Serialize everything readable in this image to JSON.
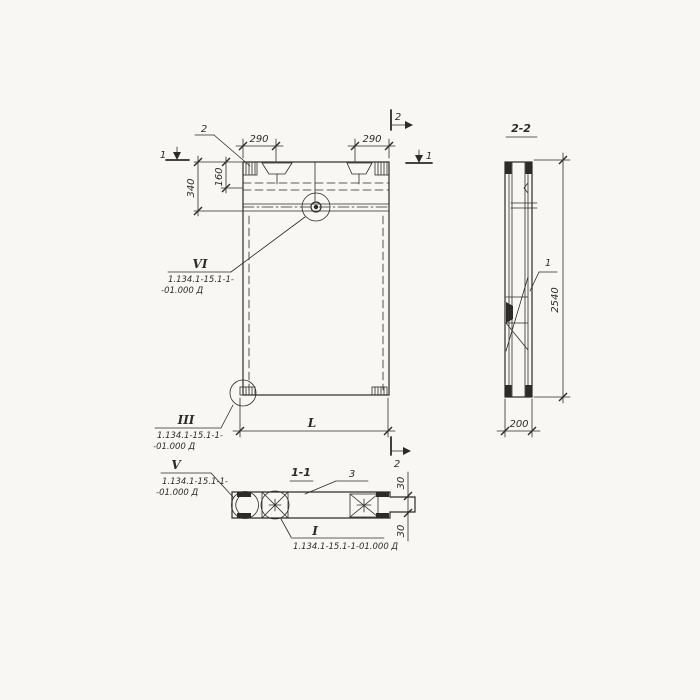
{
  "colors": {
    "ink": "#2e2b27",
    "paper": "#f8f7f4"
  },
  "front": {
    "marks": {
      "cut1_left": "1",
      "cut1_right": "1",
      "cut2_top": "2",
      "cut2_bottom": "2"
    },
    "dims": {
      "recess_left": "290",
      "recess_right": "290",
      "band_height": "340",
      "recess_depth": "160",
      "length": "L"
    },
    "item2_label": "2",
    "detail_vi": {
      "num": "VI",
      "ref1": "1.134.1-15.1-1-",
      "ref2": "-01.000 Д"
    },
    "detail_iii": {
      "num": "III",
      "ref1": "1.134.1-15.1-1-",
      "ref2": "-01.000 Д"
    }
  },
  "section11": {
    "title": "1-1",
    "item3_label": "3",
    "dims": {
      "rebate_top": "30",
      "rebate_bottom": "30"
    },
    "detail_v": {
      "num": "V",
      "ref1": "1.134.1-15.1-1-",
      "ref2": "-01.000 Д"
    },
    "detail_i": {
      "num": "I",
      "ref": "1.134.1-15.1-1-01.000 Д"
    }
  },
  "section22": {
    "title": "2-2",
    "item1_label": "1",
    "dims": {
      "height": "2540",
      "width": "200"
    }
  }
}
